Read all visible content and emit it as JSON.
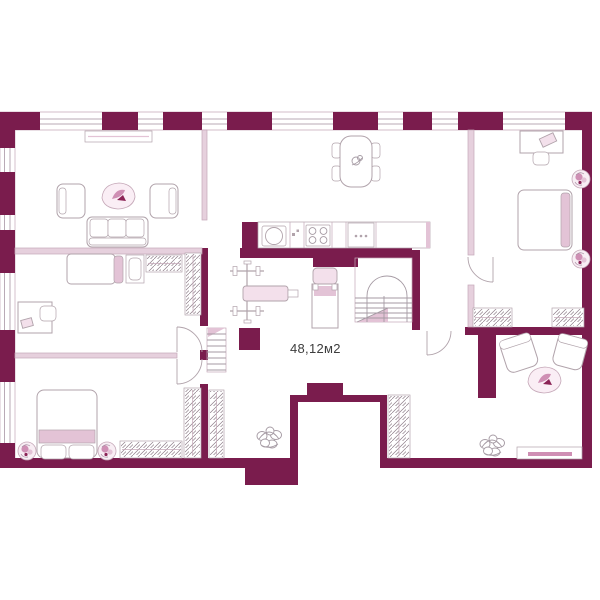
{
  "plan": {
    "area_label": "48,12м2"
  },
  "colors": {
    "wall": "#7a1c4d",
    "wall_edge": "#5e1038",
    "partition": "#e6d0dd",
    "partition_edge": "#c5a8b8",
    "window_line": "#b9aab6",
    "furniture_stroke": "#b1a3ab",
    "furniture_fill": "#ffffff",
    "pink_soft": "#f3e0eb",
    "pink_mid": "#e3c3d6",
    "pink_strong": "#cf8fb4",
    "accent_dark": "#8b2456",
    "sketch": "#a59aa3",
    "rug_fill": "#faeef5",
    "text": "#3d3d3d",
    "background": "#ffffff"
  }
}
